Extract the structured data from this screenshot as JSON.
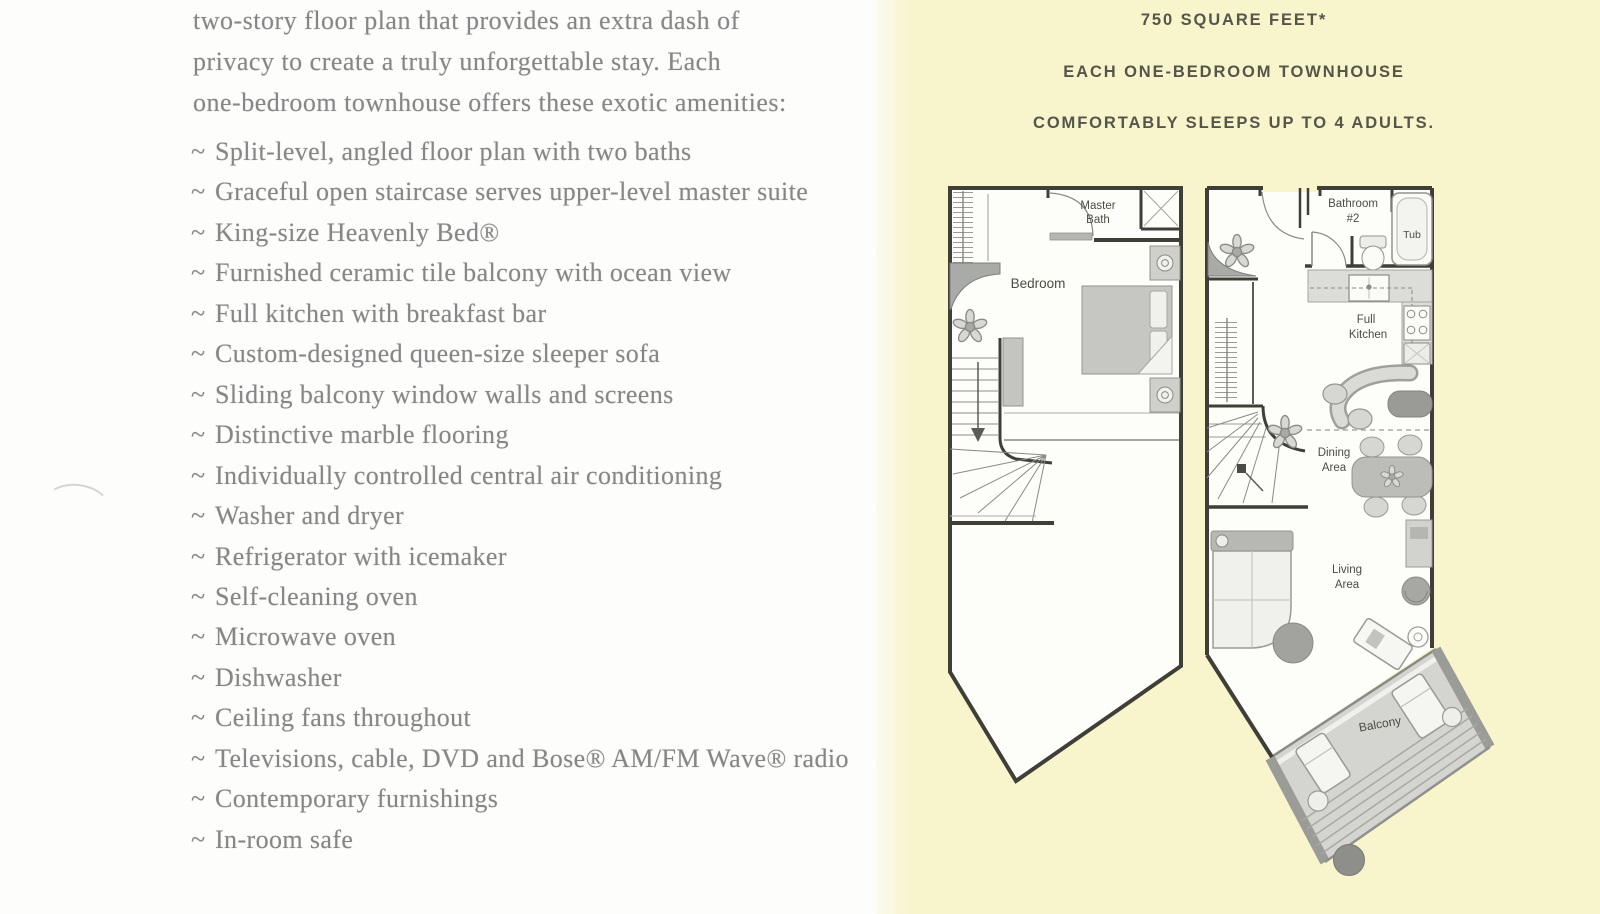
{
  "colors": {
    "paper-white": "#fdfdfc",
    "page-yellow": "#f8f5cd",
    "body-text": "#868686",
    "header-text": "#56554a",
    "plan-wall": "#3f3f38"
  },
  "left_column": {
    "intro_lines": [
      "two-story floor plan that provides an extra dash of",
      "privacy to create a truly unforgettable stay. Each",
      "one-bedroom townhouse offers these exotic amenities:"
    ],
    "amenities": {
      "bullet": "~",
      "items": [
        "Split-level, angled floor plan with two baths",
        "Graceful open staircase serves upper-level master suite",
        "King-size Heavenly Bed®",
        "Furnished ceramic tile balcony with ocean view",
        "Full kitchen with breakfast bar",
        "Custom-designed queen-size sleeper sofa",
        "Sliding balcony window walls and screens",
        "Distinctive marble flooring",
        "Individually controlled central air conditioning",
        "Washer and dryer",
        "Refrigerator with icemaker",
        "Self-cleaning oven",
        "Microwave oven",
        "Dishwasher",
        "Ceiling fans throughout",
        "Televisions, cable, DVD and Bose® AM/FM Wave® radio",
        "Contemporary furnishings",
        "In-room safe"
      ]
    }
  },
  "right_panel": {
    "header_lines": [
      "750 SQUARE FEET*",
      "EACH ONE-BEDROOM TOWNHOUSE",
      "COMFORTABLY SLEEPS UP TO 4 ADULTS."
    ],
    "floor_plans": {
      "upper_level": {
        "labels": {
          "master_bath": [
            "Master",
            "Bath"
          ],
          "bedroom": "Bedroom"
        }
      },
      "main_level": {
        "labels": {
          "bathroom2": [
            "Bathroom",
            "#2"
          ],
          "tub": "Tub",
          "full_kitchen": [
            "Full",
            "Kitchen"
          ],
          "dining": [
            "Dining",
            "Area"
          ],
          "living": [
            "Living",
            "Area"
          ],
          "balcony": "Balcony"
        }
      }
    }
  }
}
